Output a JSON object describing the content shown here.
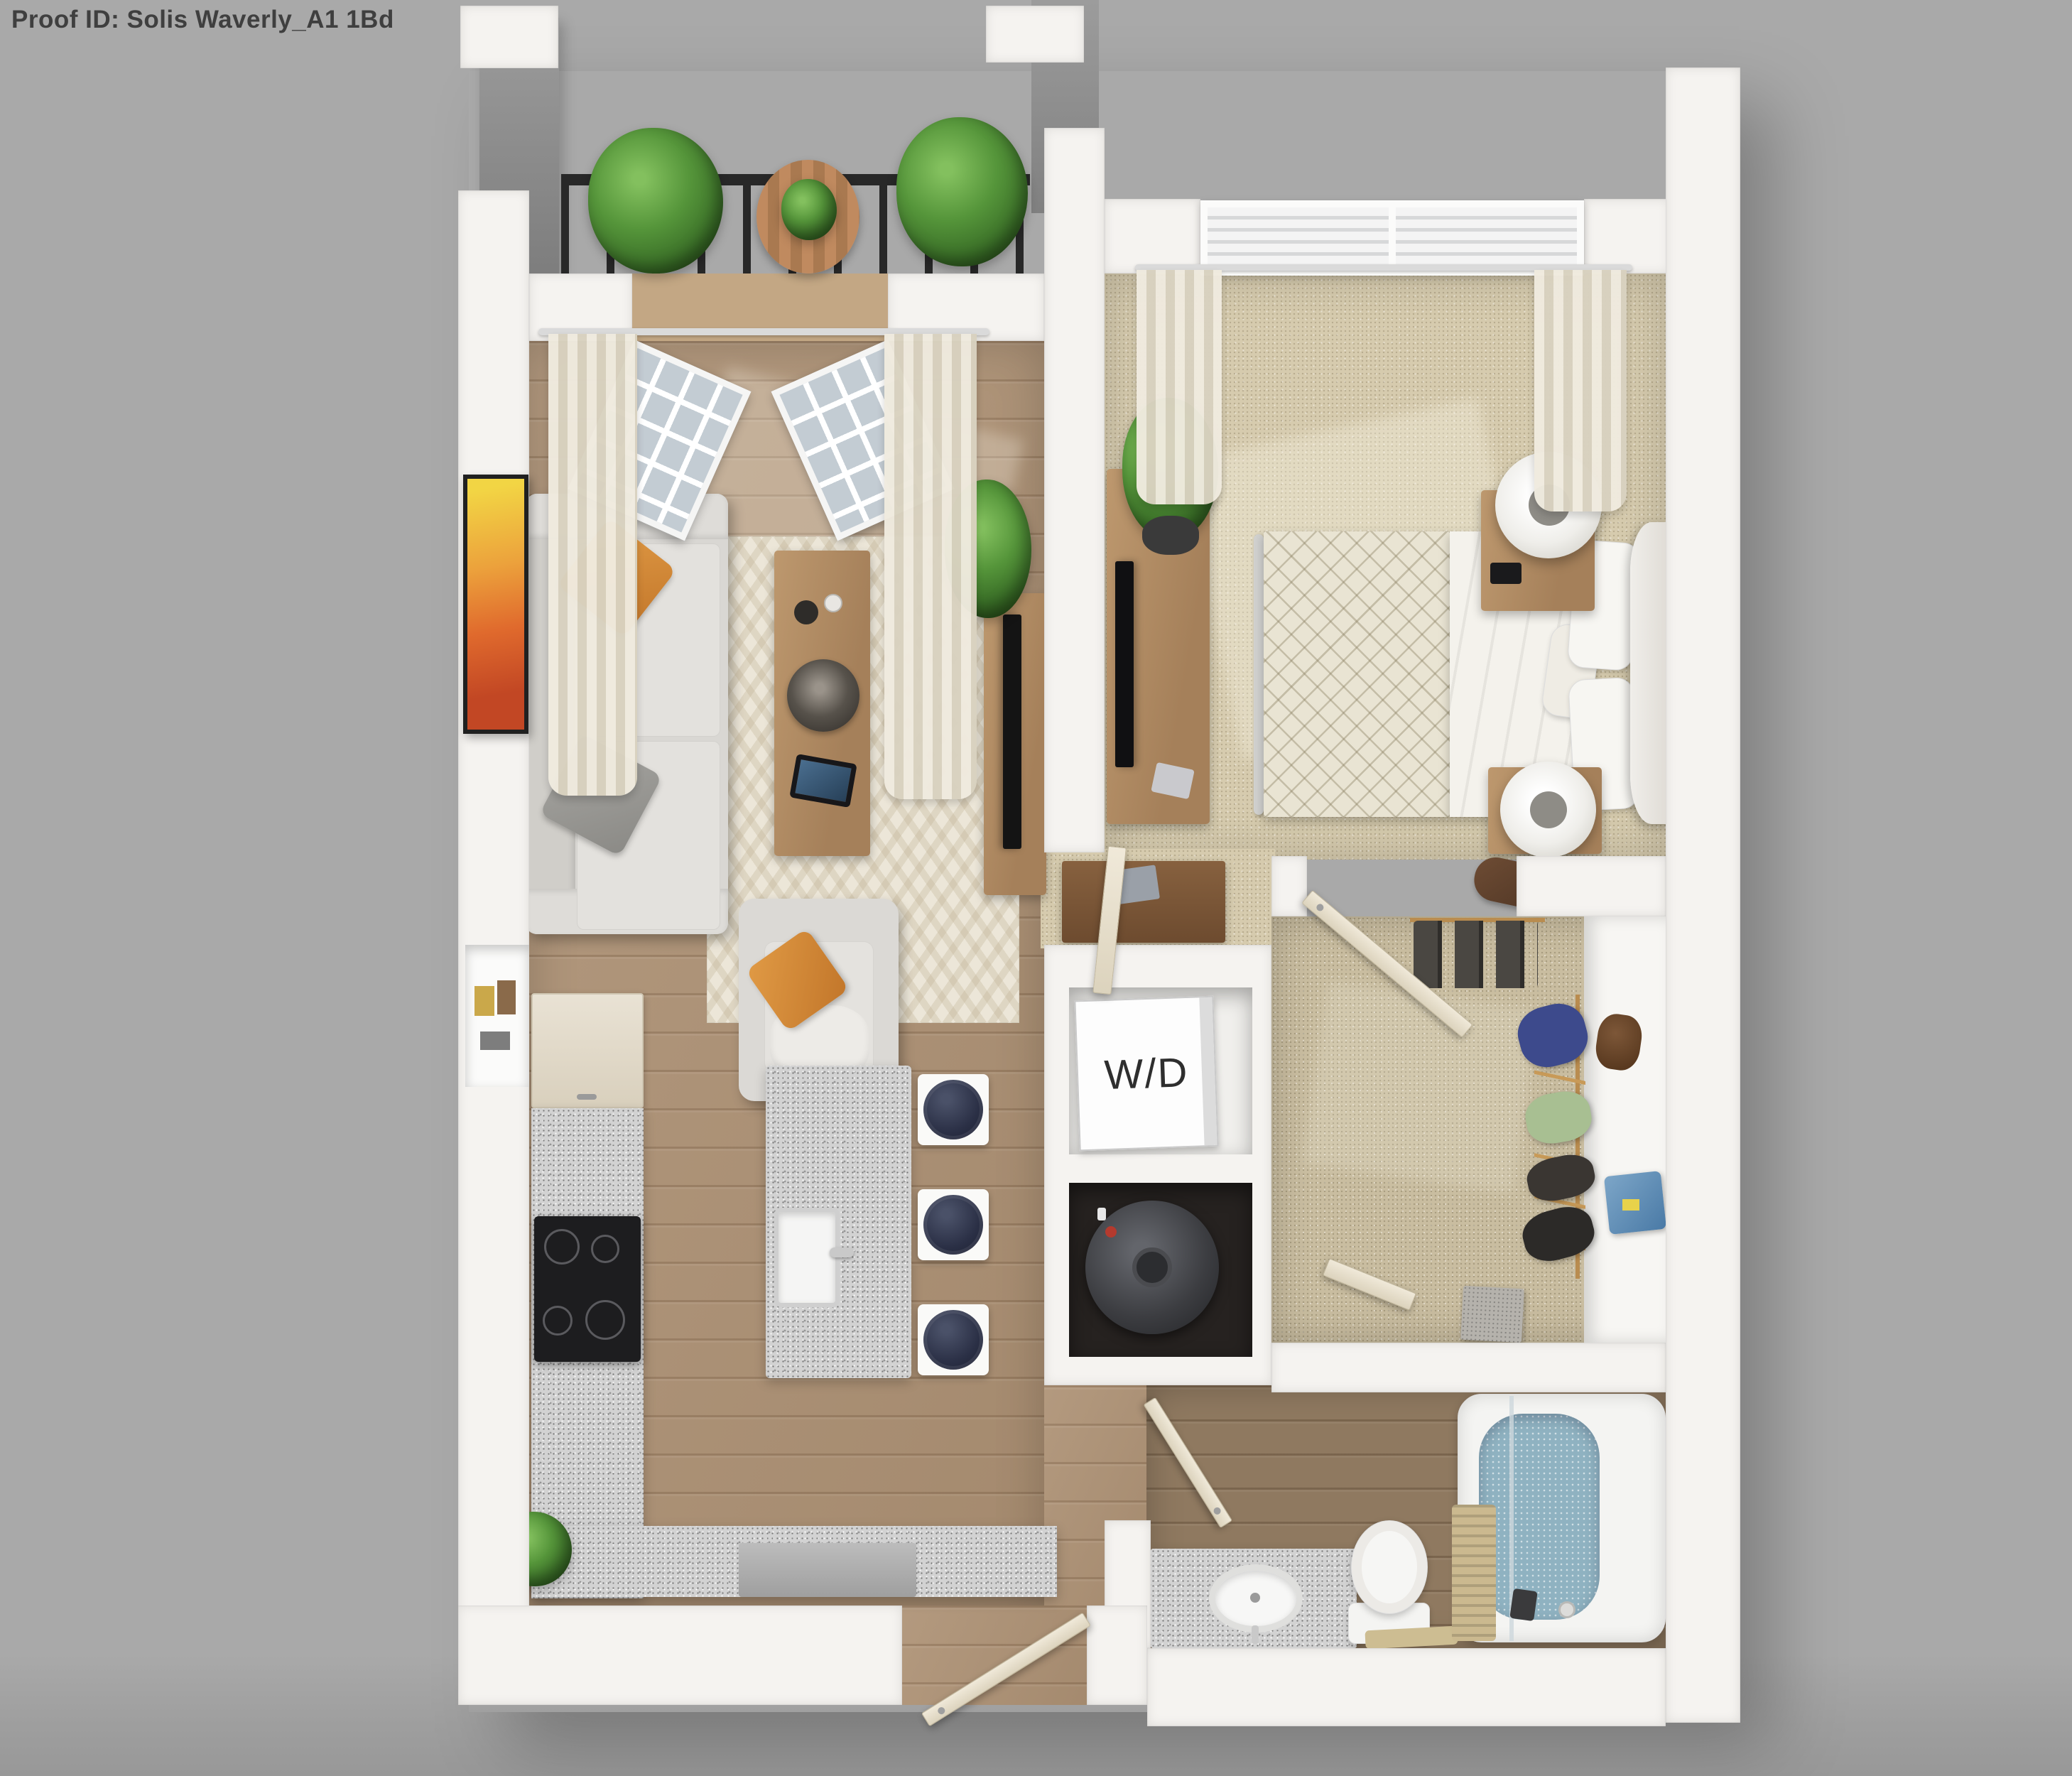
{
  "header": {
    "proof_id": "Proof ID: Solis Waverly_A1 1Bd"
  },
  "laundry": {
    "washer_dryer_label": "W/D"
  },
  "palette": {
    "background": "#a8a8a8",
    "wall": "#f5f3f0",
    "wood_floor": "#ad9174",
    "bathroom_floor": "#8f7960",
    "carpet_bedroom": "#d6cbae",
    "carpet_closet": "#c9bda0",
    "granite": "#d2d2d2",
    "bath_water": "#8fb2c1",
    "sofa_gray": "#d9d7d3",
    "pillow_orange": "#d68e3d",
    "plant_green": "#4f8c37",
    "door_cream": "#e9e2d0",
    "railing_black": "#282828"
  }
}
